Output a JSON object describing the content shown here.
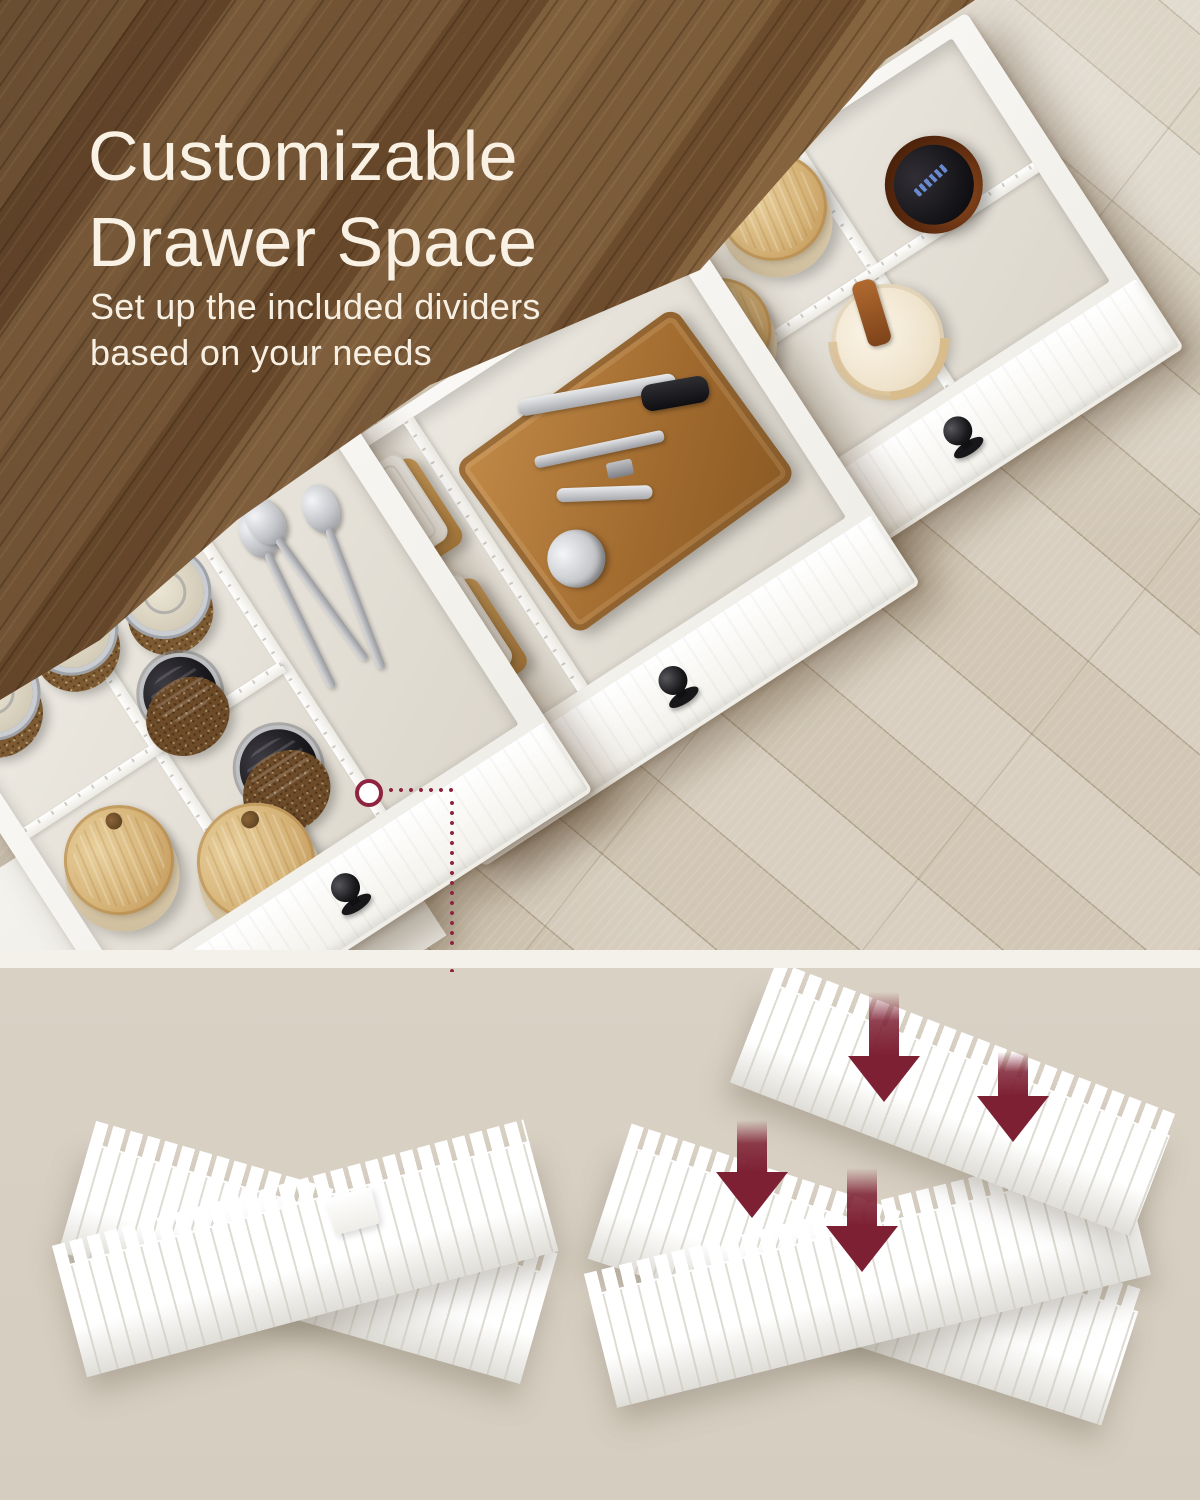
{
  "hero": {
    "title_line1": "Customizable",
    "title_line2": "Drawer Space",
    "subtitle_line1": "Set up the included dividers",
    "subtitle_line2": "based on your needs"
  },
  "colors": {
    "heading_text": "#f8f1e4",
    "accent_maroon": "#8e2440",
    "arrow_maroon": "#7d2033",
    "countertop_wood": "#7a5834",
    "floor_wood": "#d5ccbb",
    "drawer_white": "#f8f7f3",
    "photo_strip": "#f4f1ea",
    "bottom_background": "#d7cfc1"
  },
  "photo_objects": {
    "drawer_top_items": [
      "bamboo-lid-canister",
      "bamboo-lid-canister",
      "amber-glass-jar",
      "cream-canister-with-strap"
    ],
    "drawer_middle_items": [
      "white-food-container",
      "white-food-container",
      "bamboo-tray",
      "ice-cream-scoop",
      "corkscrew",
      "black-handle-tool"
    ],
    "drawer_bottom_items": [
      "clamp-lid-spice-jar",
      "clamp-lid-spice-jar",
      "clamp-lid-spice-jar",
      "black-cap-shaker",
      "black-cap-shaker",
      "bamboo-lid-jar",
      "bamboo-lid-jar",
      "spoons"
    ]
  },
  "diagram": {
    "left_figure": "assembled-divider-cross",
    "right_figure": "divider-assembly-with-arrows",
    "arrow_icon": "arrow-down-icon",
    "arrow_count": 4,
    "marker_icon": "circle-marker-icon"
  }
}
